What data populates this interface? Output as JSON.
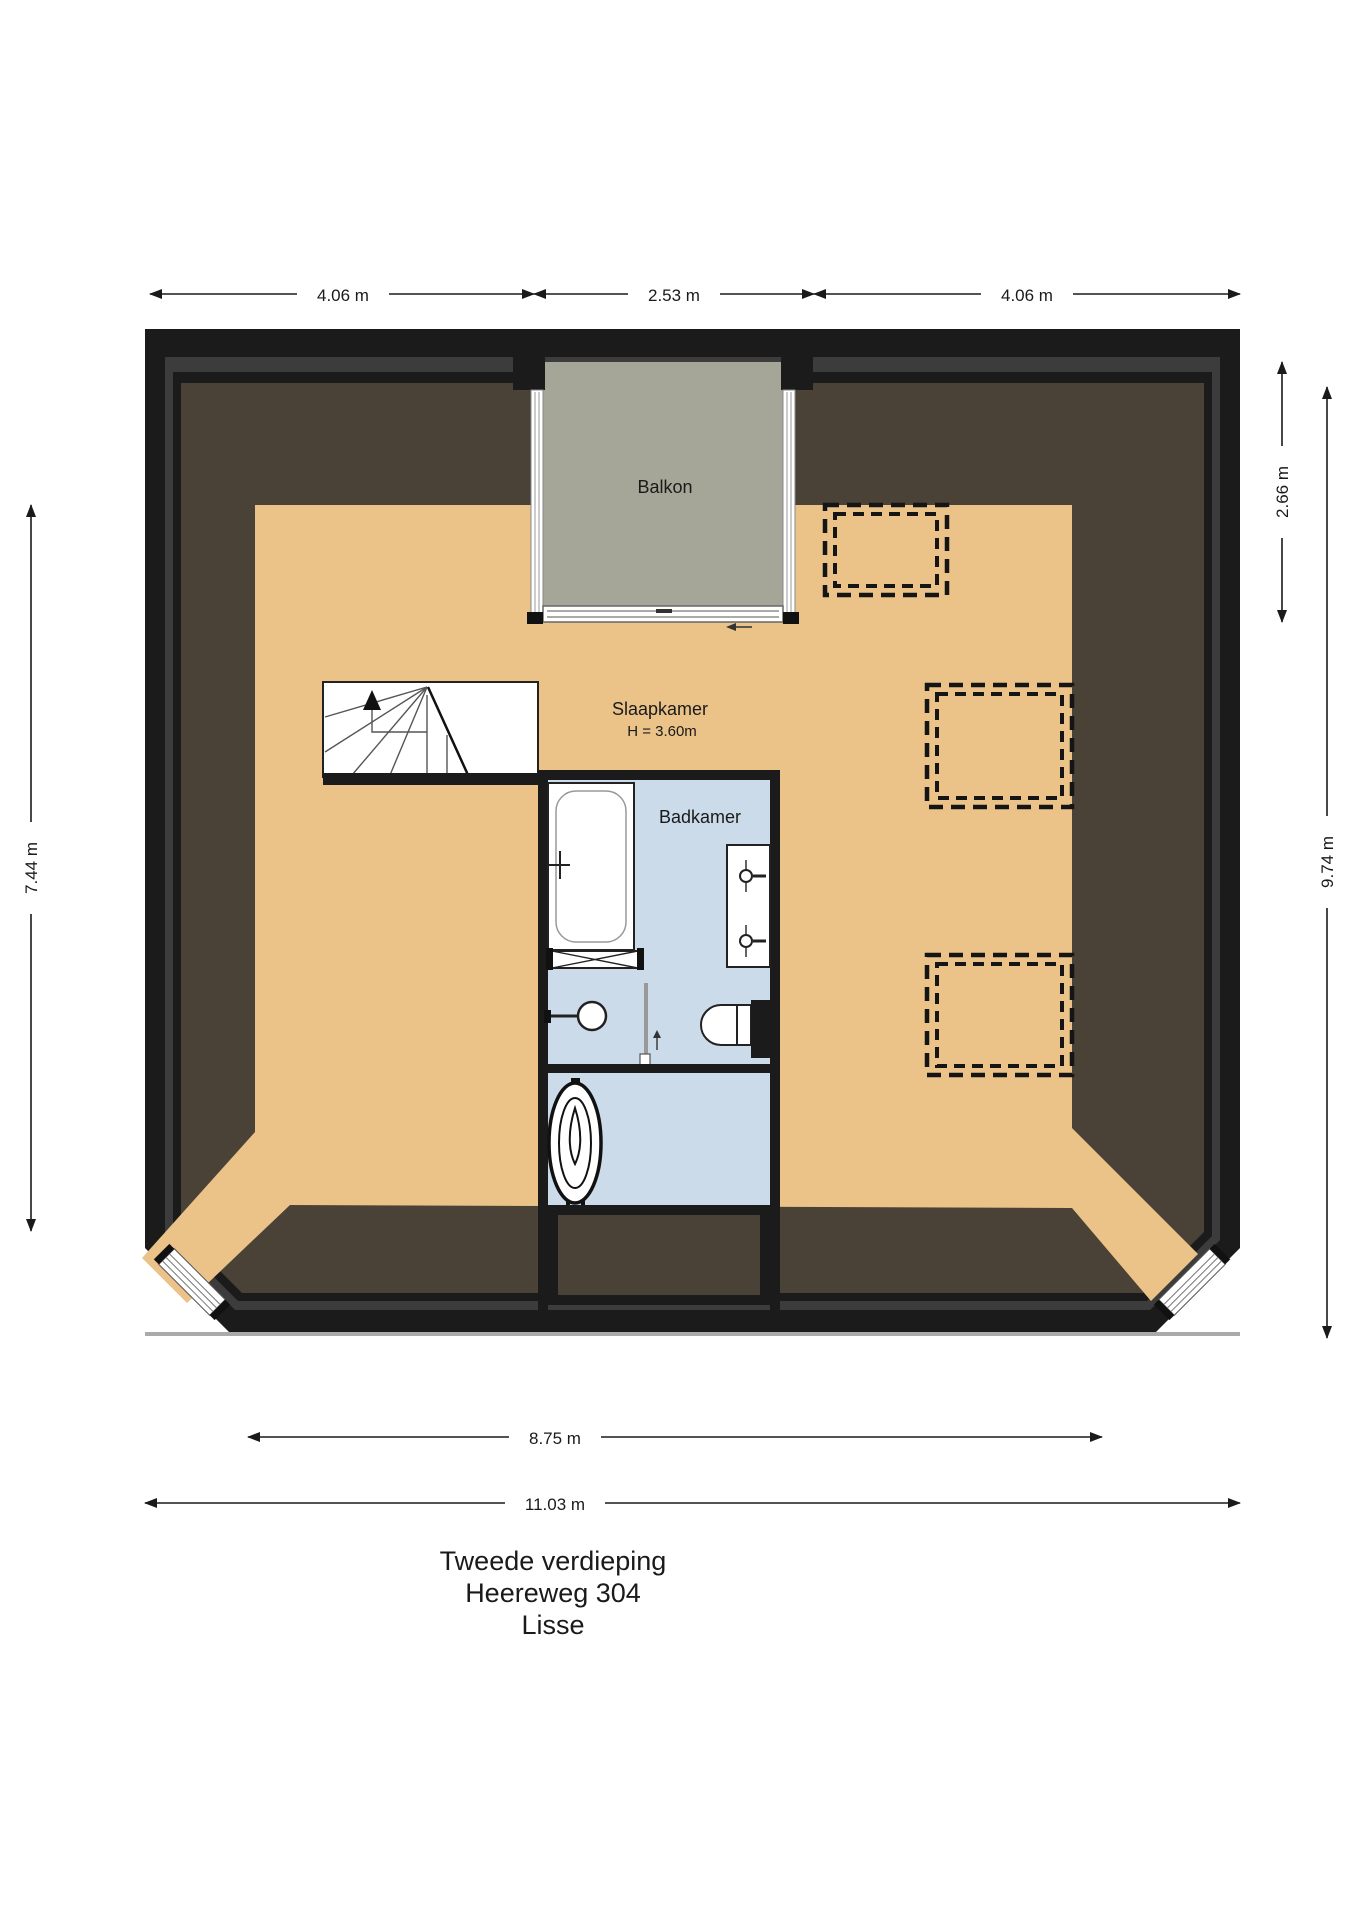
{
  "title": {
    "line1": "Tweede verdieping",
    "line2": "Heereweg 304",
    "line3": "Lisse"
  },
  "rooms": {
    "balcony": "Balkon",
    "bedroom": "Slaapkamer",
    "bedroom_height": "H = 3.60m",
    "bathroom": "Badkamer"
  },
  "dimensions": {
    "top_left": "4.06 m",
    "top_middle": "2.53 m",
    "top_right": "4.06 m",
    "right_upper": "2.66 m",
    "right_full": "9.74 m",
    "left": "7.44 m",
    "bottom_inner": "8.75 m",
    "bottom_full": "11.03 m"
  },
  "colors": {
    "wall": "#1B1B1B",
    "wall_shadow": "#3C3C3C",
    "roof": "#4A4237",
    "floor": "#EBC389",
    "balcony": "#A5A698",
    "bathroom": "#CBDBEA",
    "fixture": "#FFFFFF",
    "stroke": "#222222"
  }
}
